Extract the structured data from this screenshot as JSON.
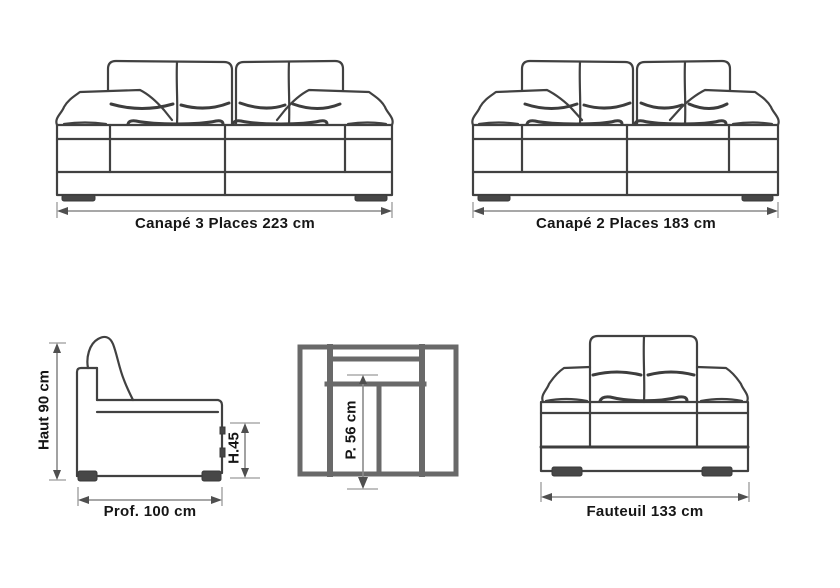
{
  "title": "Sofa set dimension diagram",
  "colors": {
    "background": "#ffffff",
    "line": "#414141",
    "thick_line": "#696969",
    "dimension_line": "#8a8a8a",
    "text": "#161616"
  },
  "figures": {
    "sofa3": {
      "label": "Canapé 3 Places 223 cm"
    },
    "sofa2": {
      "label": "Canapé 2 Places 183 cm"
    },
    "side_view": {
      "height_label": "Haut 90 cm",
      "armrest_height_label": "H.45",
      "depth_label": "Prof. 100 cm"
    },
    "top_view": {
      "seat_depth_label": "P. 56 cm"
    },
    "armchair": {
      "label": "Fauteuil 133 cm"
    }
  }
}
